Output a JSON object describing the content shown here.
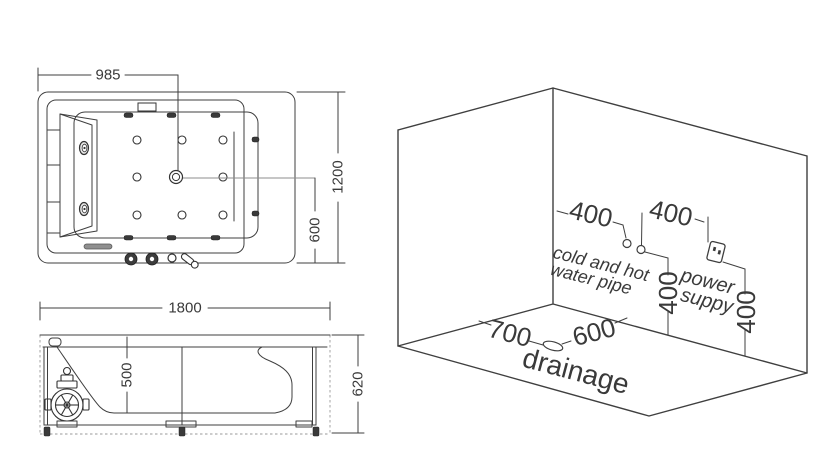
{
  "top_view": {
    "dim_width_to_drain": "985",
    "dim_length": "1200",
    "dim_drain_offset": "600"
  },
  "side_view": {
    "dim_length": "1800",
    "dim_depth": "500",
    "dim_height": "620"
  },
  "room_view": {
    "dim_pipe_spacing": "400",
    "dim_outlet_spacing": "400",
    "dim_pipe_height": "400",
    "dim_outlet_height": "400",
    "dim_drain_from_left": "700",
    "dim_drain_from_right": "600",
    "label_pipe_line1": "cold and hot",
    "label_pipe_line2": "water pipe",
    "label_power_line1": "power",
    "label_power_line2": "suppy",
    "label_drainage": "drainage"
  },
  "colors": {
    "line": "#3f3f3f",
    "line_light": "#8c8c8c",
    "dark_fill": "#3a3a3a",
    "background": "#ffffff"
  }
}
